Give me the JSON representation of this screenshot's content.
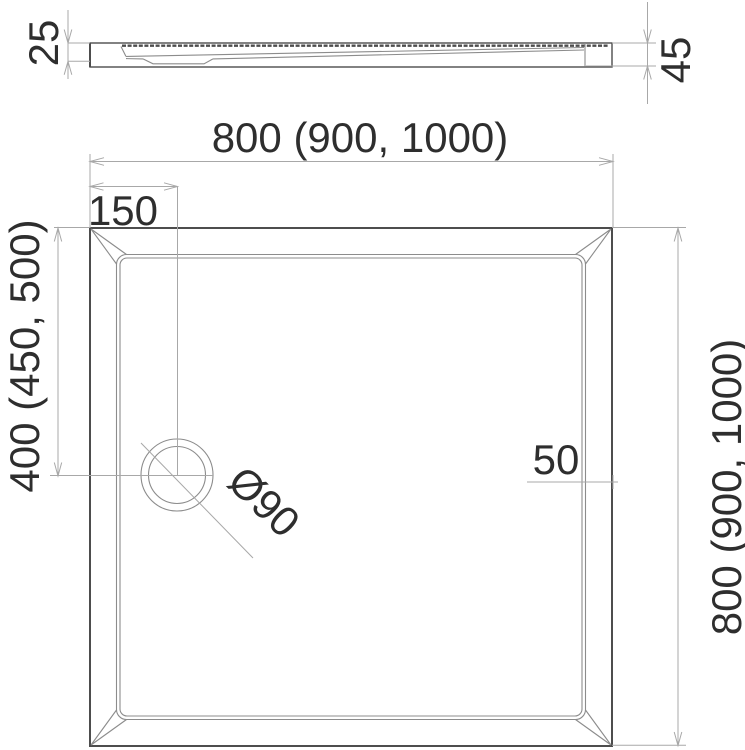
{
  "labels": {
    "profile_rim_height": "25",
    "profile_total_height": "45",
    "plan_width": "800 (900, 1000)",
    "plan_height": "800 (900, 1000)",
    "drain_offset_x": "150",
    "drain_offset_y": "400 (450, 500)",
    "rim_width": "50",
    "drain_diameter": "Ø90"
  },
  "colors": {
    "outline": "#4d4d4d",
    "thin_line": "#8c8c8c",
    "dim_line": "#a8a8a8",
    "text": "#2e2e2e",
    "background": "#ffffff"
  }
}
